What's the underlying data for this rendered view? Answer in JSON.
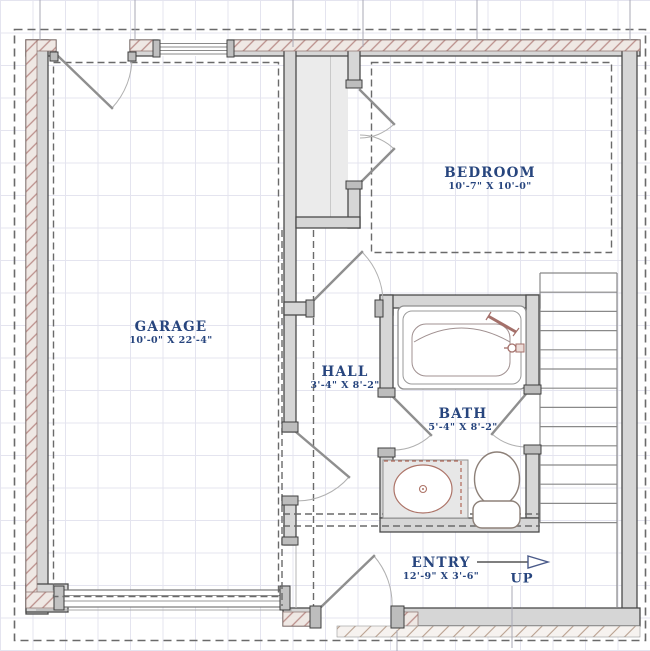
{
  "plan": {
    "rooms": [
      {
        "id": "garage",
        "name": "GARAGE",
        "dims": "10'-0\" X 22'-4\""
      },
      {
        "id": "bedroom",
        "name": "BEDROOM",
        "dims": "10'-7\" X 10'-0\""
      },
      {
        "id": "hall",
        "name": "HALL",
        "dims": "3'-4\" X 8'-2\""
      },
      {
        "id": "bath",
        "name": "BATH",
        "dims": "5'-4\" X 8'-2\""
      },
      {
        "id": "entry",
        "name": "ENTRY",
        "dims": "12'-9\" X 3'-6\""
      }
    ],
    "stairs": {
      "direction_label": "UP"
    },
    "colors": {
      "label_text": "#27457e",
      "wall_fill": "#d6d6d6",
      "wall_stroke": "#4a4a4a",
      "brick_hatch": "#bb8f8b",
      "grid_line": "#e4e4ef",
      "fixture_accent": "#a4706a",
      "dashed_line": "#6a6a6a"
    }
  }
}
